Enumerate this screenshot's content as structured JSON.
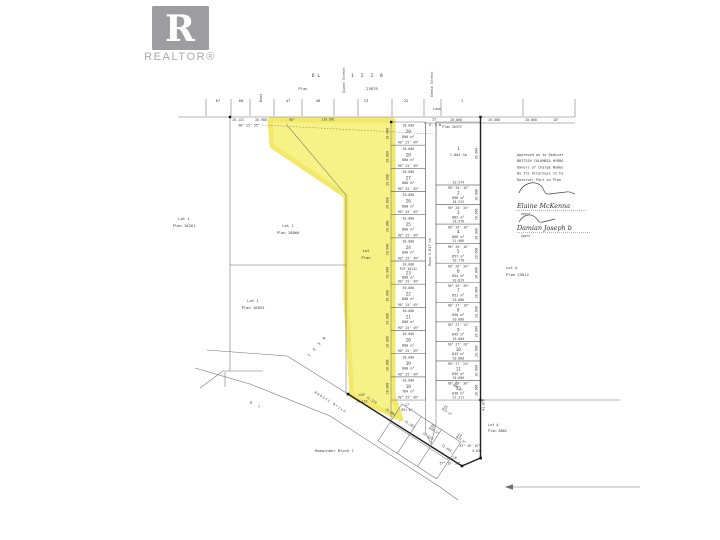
{
  "logo": {
    "r": "R",
    "label": "REALTOR®"
  },
  "colors": {
    "highlight": "#f7f17b",
    "highlight_edge": "#f1e75f",
    "logo_gray": "#9c9ca1"
  },
  "header": {
    "dl": "D L",
    "dl_num": "1 2 2 8",
    "plan_label": "Plan",
    "plan_num": "23879",
    "lane": "Lane",
    "plan_right": "Plan 26373"
  },
  "streets": {
    "road_top": "Road",
    "queen": "Queen Street",
    "dease": "Dease Street",
    "road_mid": "Road   2.017 ha",
    "abbott": "Abbott   Drive",
    "dl_road": "D L"
  },
  "top_lot_numbers": [
    "67",
    "68",
    "47",
    "48",
    "23",
    "22",
    "1"
  ],
  "top_dims": {
    "d1": "20.115",
    "d2": "20.980",
    "b1": "90° 25' 55\"",
    "d3": "90°",
    "d4": "119.891",
    "d5": "23",
    "d6": "E. & W.",
    "d7": "20.000",
    "d8": "20.000",
    "d9": "20.000",
    "d10": "10°"
  },
  "neighbors": {
    "nw1a": "Lot 1",
    "nw1b": "Plan 18261",
    "nw2a": "Lot 1",
    "nw2b": "Plan 28066",
    "nw3a": "Lot 1",
    "nw3b": "Plan 16853",
    "e1a": "Lot A",
    "e1b": "Plan 25012",
    "se1a": "Lot A",
    "se1b": "Plan 8802"
  },
  "misc": {
    "dl1339": "1 3 3 9",
    "remainder": "Remainder Block C"
  },
  "parcel": {
    "line1": "Lot",
    "line2": "Plan",
    "corner_angle": "110°",
    "corner_dim": "21.122"
  },
  "west_lots": [
    {
      "no": "29",
      "area": "800 m²",
      "top": "30.000",
      "brg": "90° 25' 49\"",
      "side": "20.000"
    },
    {
      "no": "28",
      "area": "800 m²",
      "top": "30.000",
      "brg": "90° 25' 49\"",
      "side": "20.000"
    },
    {
      "no": "27",
      "area": "800 m²",
      "top": "30.000",
      "brg": "90° 25' 49\"",
      "side": "20.000"
    },
    {
      "no": "26",
      "area": "800 m²",
      "top": "30.000",
      "brg": "90° 25' 49\"",
      "side": "20.000"
    },
    {
      "no": "25",
      "area": "800 m²",
      "top": "30.000",
      "brg": "90° 25' 49\"",
      "side": "20.000"
    },
    {
      "no": "24",
      "area": "800 m²",
      "top": "30.000",
      "brg": "90° 25' 49\"",
      "side": "20.000"
    },
    {
      "no": "23",
      "area": "888 m²",
      "top": "30.000",
      "pre": "PCP 30112",
      "brg": "90° 25' 49\"",
      "side": "20.000"
    },
    {
      "no": "22",
      "area": "800 m²",
      "top": "30.000",
      "brg": "90° 25' 49\"",
      "side": "20.000"
    },
    {
      "no": "21",
      "area": "800 m²",
      "top": "30.000",
      "brg": "90° 25' 49\"",
      "side": "20.000"
    },
    {
      "no": "20",
      "area": "800 m²",
      "top": "30.000",
      "brg": "90° 25' 49\"",
      "side": "20.000"
    },
    {
      "no": "19",
      "area": "800 m²",
      "top": "30.000",
      "brg": "90° 25' 49\"",
      "side": "20.000"
    },
    {
      "no": "18",
      "area": "784 m²",
      "top": "30.000",
      "brg": "90° 25' 49\"",
      "side": "20.000"
    }
  ],
  "lot17": {
    "no": "17",
    "area": "891 m²"
  },
  "east_lots": [
    {
      "no": "1",
      "area": "1.004 ha",
      "dim": "20.574",
      "brg": "",
      "side": "20.000"
    },
    {
      "no": "2",
      "area": "898 m²",
      "dim": "28.225",
      "brg": "90° 28' 16\"",
      "side": "20.000"
    },
    {
      "no": "3",
      "area": "883 m²",
      "dim": "28.976",
      "brg": "90° 28' 34\"",
      "side": "20.000"
    },
    {
      "no": "4",
      "area": "868 m²",
      "dim": "21.986",
      "brg": "90° 26' 18\"",
      "side": "20.000"
    },
    {
      "no": "5",
      "area": "857 m²",
      "dim": "20.778",
      "brg": "90° 26' 16\"",
      "side": "20.000"
    },
    {
      "no": "6",
      "area": "854 m²",
      "dim": "20.829",
      "brg": "90° 26' 34\"",
      "side": "20.000"
    },
    {
      "no": "7",
      "area": "851 m²",
      "dim": "20.880",
      "brg": "90° 26' 39\"",
      "side": "20.000"
    },
    {
      "no": "8",
      "area": "848 m²",
      "dim": "20.880",
      "brg": "90° 27' 10\"",
      "side": "20.000"
    },
    {
      "no": "9",
      "area": "845 m²",
      "dim": "20.880",
      "brg": "90° 27' 14\"",
      "side": "20.000"
    },
    {
      "no": "10",
      "area": "843 m²",
      "dim": "20.880",
      "brg": "90° 27' 20\"",
      "side": "20.000"
    },
    {
      "no": "11",
      "area": "839 m²",
      "dim": "20.880",
      "brg": "90° 27' 24\"",
      "side": "20.000"
    },
    {
      "no": "12",
      "area": "836 m²",
      "dim": "21.311",
      "brg": "90° 27' 30\"",
      "side": "20.000"
    }
  ],
  "cluster_lots": [
    {
      "no": "13",
      "area": "909 m²"
    },
    {
      "no": "15",
      "area": "921 m²"
    },
    {
      "no": "16",
      "area": "648 m²"
    },
    {
      "no": "14",
      "area": "973 m²"
    }
  ],
  "road_dims": [
    "21.570",
    "26.002",
    "25.302",
    "21.319",
    "71.466"
  ],
  "corner_dims": {
    "c1": "87° 49' 07\"",
    "c2": "5.633",
    "c3": "6.116",
    "c4": "57° 19' 36\"",
    "c5": "41.878"
  },
  "approval": {
    "lines": [
      "Approved as to Dedicat",
      "BRITISH COLUMBIA HYDRO",
      "Owners of Charge Numbe",
      "By Its Attorneys In Fa",
      "Reserve; Part on Plan"
    ],
    "sig1_name": "Elaine McKenna",
    "sig1_role": "Agent",
    "sig2_name": "Damian Joseph b",
    "sig2_role": "Agent"
  }
}
